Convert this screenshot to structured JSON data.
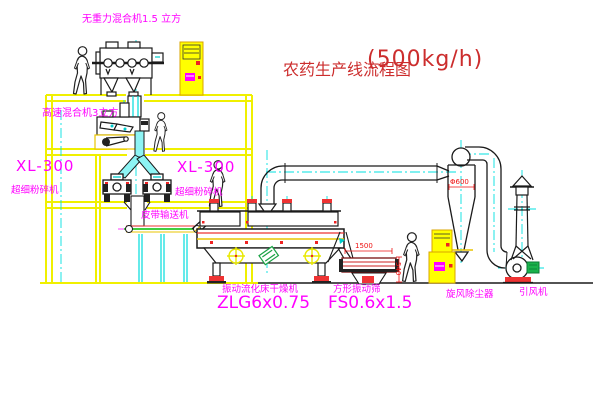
{
  "title": {
    "cn": "农药生产线流程图",
    "capacity": "(500kg/h)"
  },
  "labels": {
    "gravity_mixer": "无重力混合机1.5 立方",
    "high_speed_mixer": "高速混合机3立方",
    "mill_left_model": "XL-300",
    "mill_left_name": "超细粉碎机",
    "mill_right_model": "XL-300",
    "mill_right_name": "超细粉碎机",
    "belt_conveyor": "皮带输送机",
    "dryer_name": "振动流化床干燥机",
    "dryer_model": "ZLG6x0.75",
    "screen_name": "方形振动筛",
    "screen_model": "FS0.6x1.5",
    "cyclone_name": "旋风除尘器",
    "fan_name": "引风机"
  },
  "dimensions": {
    "screen_length": "1500",
    "screen_height": "540",
    "cyclone_diameter": "Φ600"
  },
  "colors": {
    "background": "#ffffff",
    "equipment_yellow": "#f0f000",
    "label_magenta": "#ff00ff",
    "title_red": "#cc2d2d",
    "dimension_red": "#ee1111",
    "centerline_cyan": "#00e0e0",
    "belt_green": "#00bb00",
    "motor_green": "#19b24b",
    "accent_red": "#ee3333",
    "line_black": "#1a1a1a"
  }
}
